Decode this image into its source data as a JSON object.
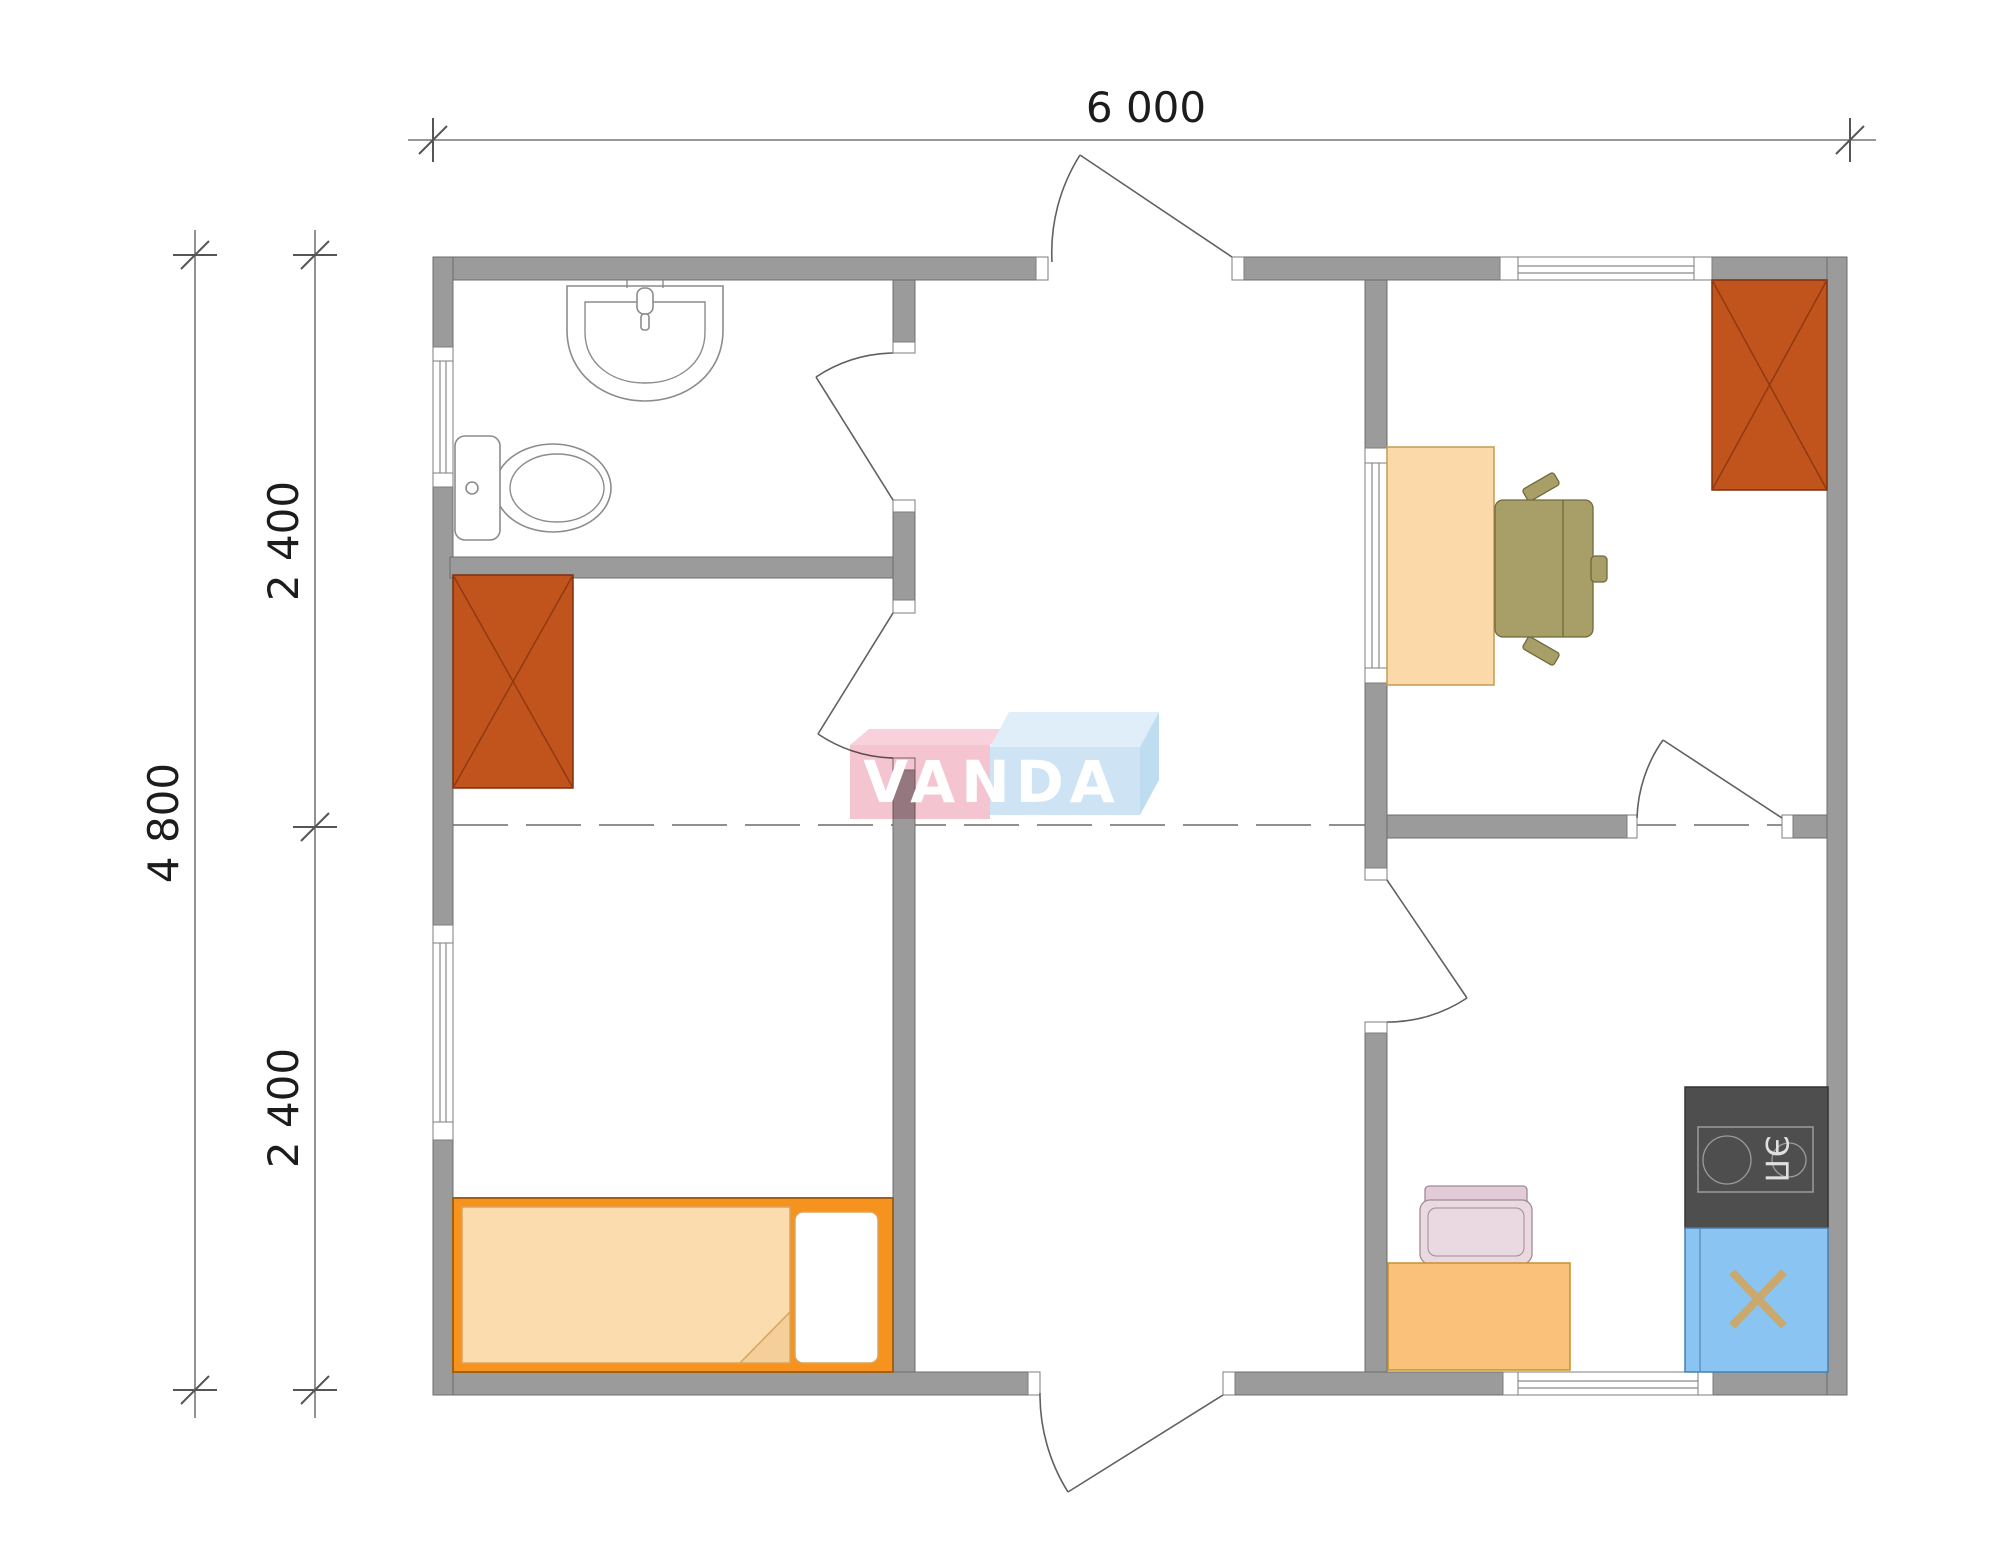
{
  "document": {
    "type": "architectural floor plan",
    "background": "#ffffff"
  },
  "dimensions": {
    "width_label": "6 000",
    "height_total_label": "4 800",
    "height_upper_label": "2 400",
    "height_lower_label": "2 400"
  },
  "watermark": {
    "text": "VANDA",
    "pink": "#f4bfcd",
    "pink_top": "#f7cdd9",
    "blue": "#cae2f5",
    "blue_top": "#ddedf9",
    "blue_side": "#badaf0",
    "text_color": "#ffffff"
  },
  "labels": {
    "stove": "ЭП"
  },
  "colors": {
    "wall": "#9b9b9b",
    "wall_outline": "#6e6e6e",
    "wardrobe": "#c1531d",
    "wardrobe_line": "#8f3a10",
    "bed_frame": "#f6921e",
    "bedding": "#fbdcae",
    "bedding_fold": "#f5cf9a",
    "pillow": "#ffffff",
    "desk": "#fbd9a9",
    "office_chair": "#a89f68",
    "kitchen_table": "#f9c179",
    "kitchen_chair": "#ead9e1",
    "kitchen_chair_back": "#e2cbd6",
    "stove": "#4e4e4e",
    "sink_unit": "#8ac4f3",
    "sink_cross": "#c9a96e",
    "dimension_text": "#1c1c1c"
  }
}
